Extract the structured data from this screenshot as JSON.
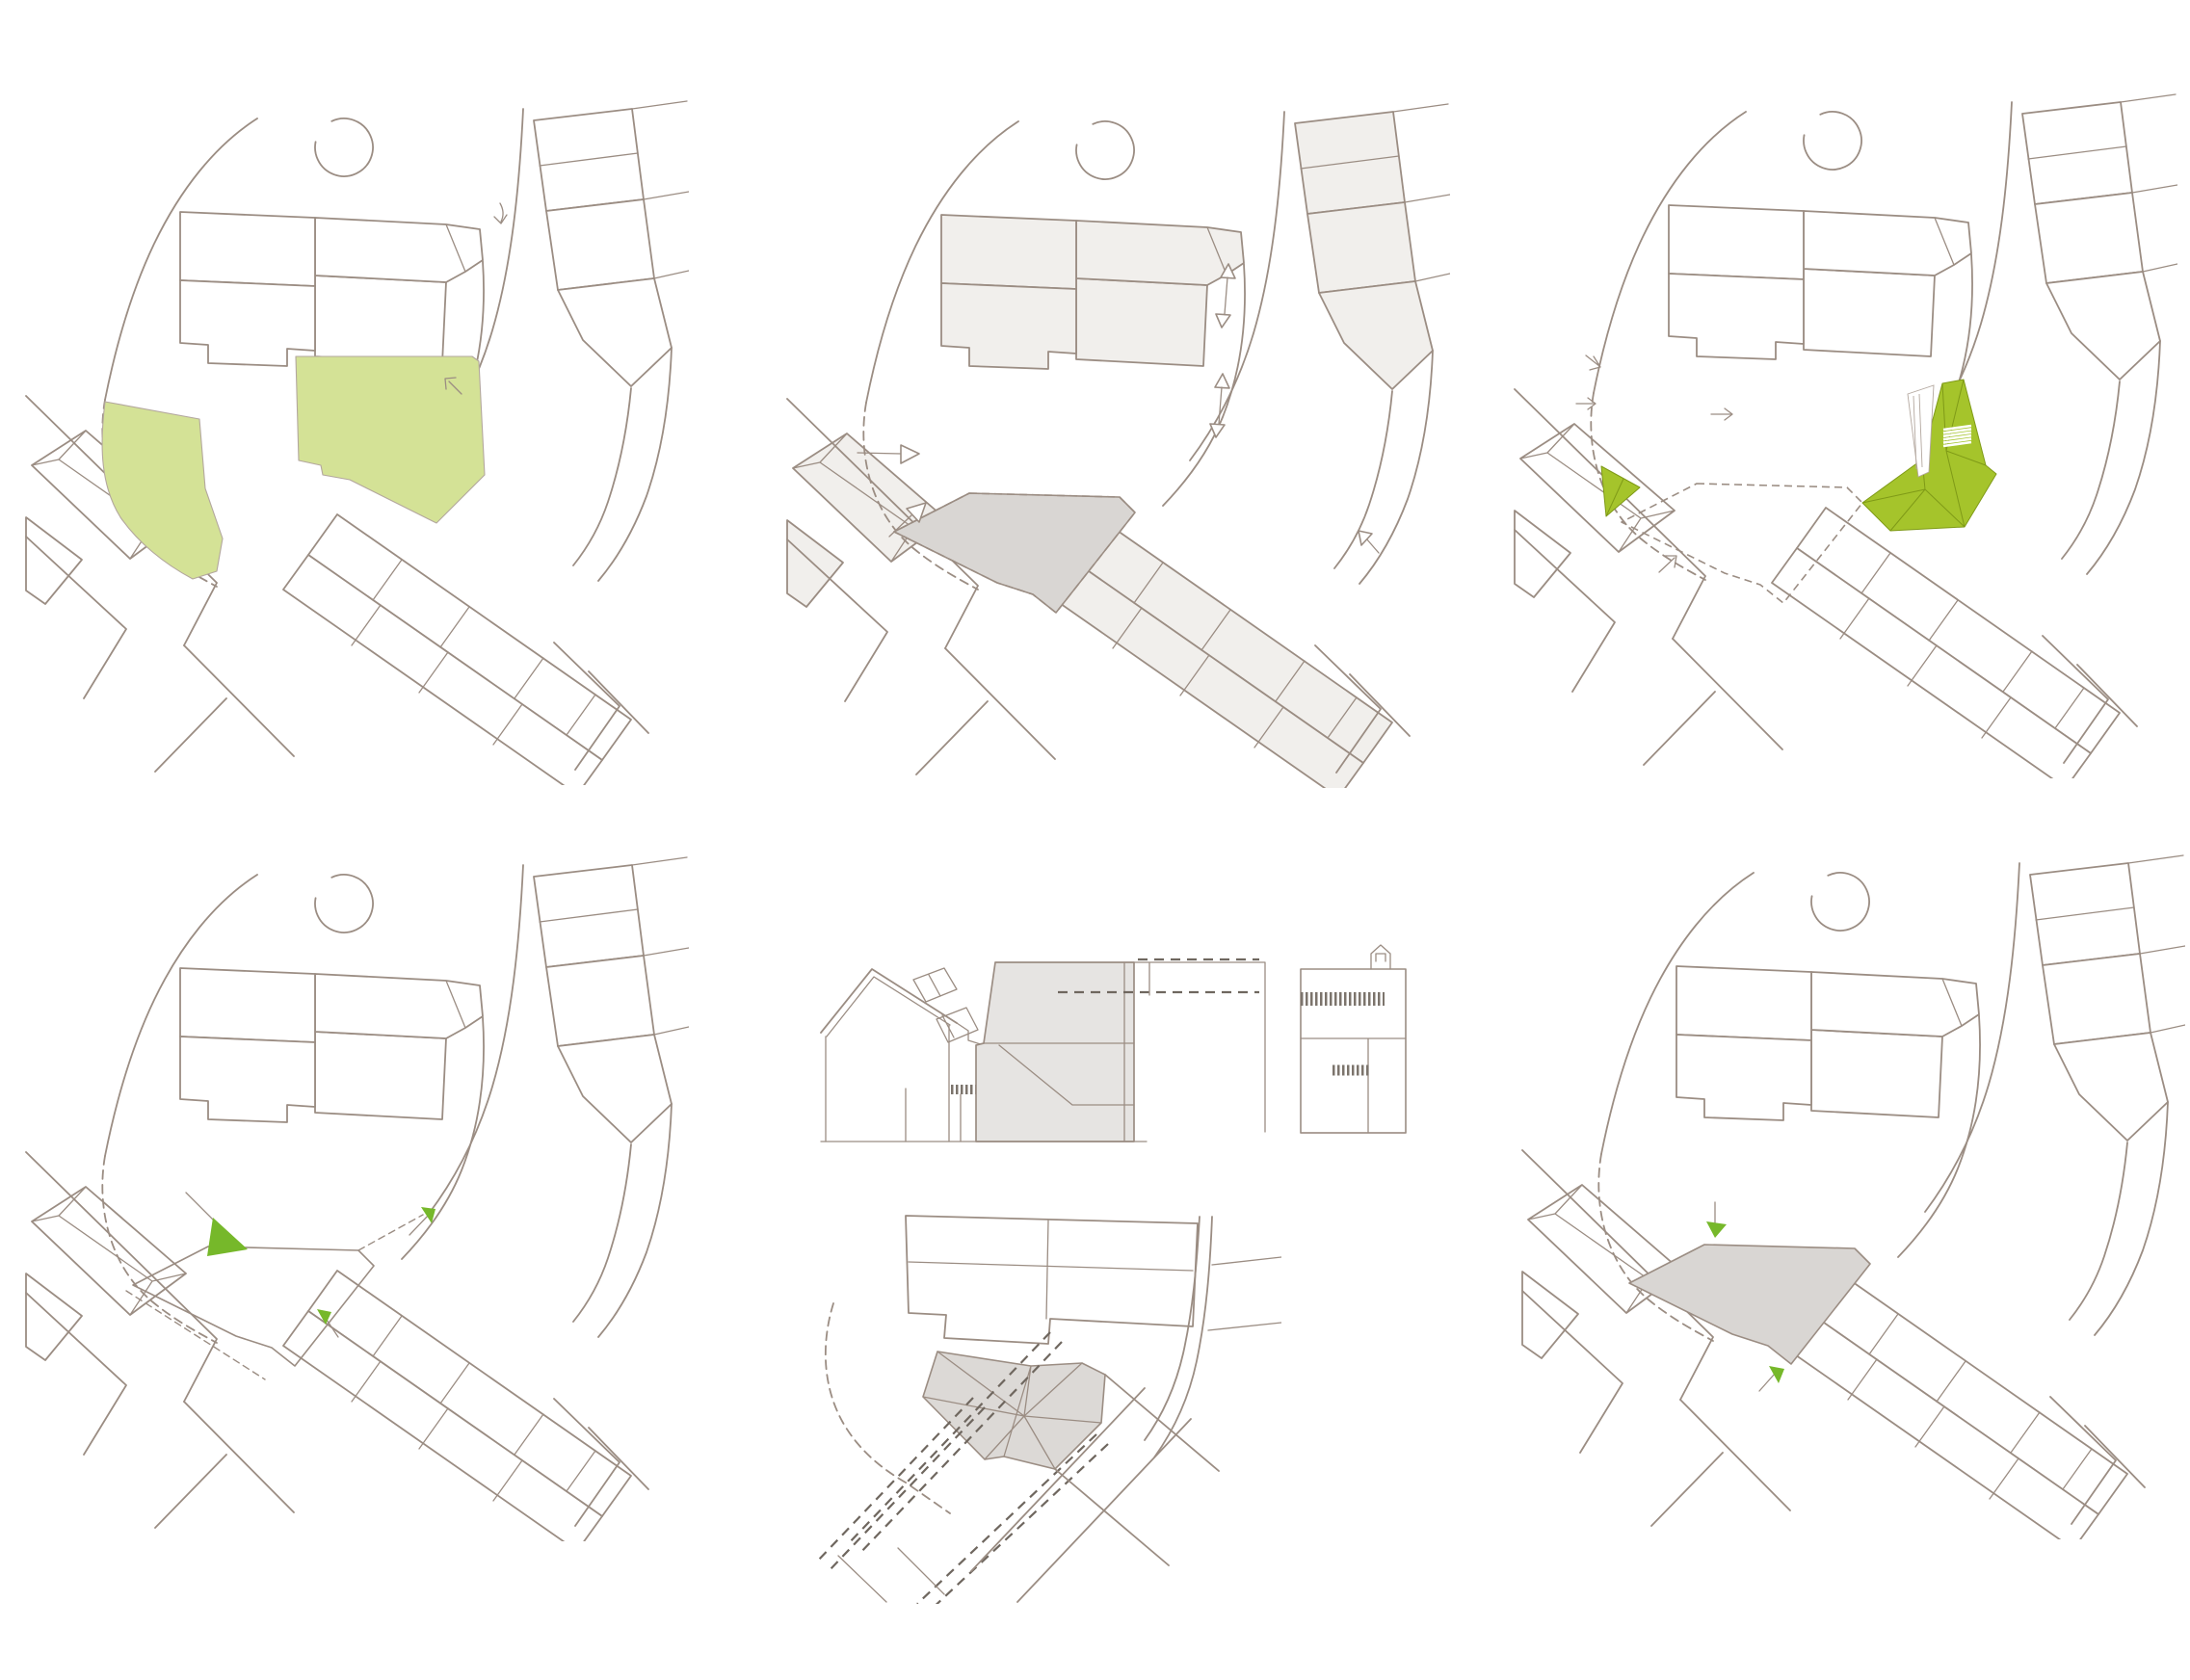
{
  "document": {
    "kind": "architectural-site-concept-diagram-sheet",
    "grid": "2 rows x 3 columns",
    "visible_text": ""
  },
  "palette": {
    "page-bg": "#ffffff",
    "line": "#9b8d83",
    "line-soft": "#b3a79e",
    "block-white": "#ffffff",
    "block-gray": "#f1efec",
    "site-gray": "#d9d6d3",
    "roof-gray": "#dcd9d6",
    "elev-gray": "#e6e4e2",
    "green-light": "#d4e296",
    "green-olive": "#a5c42b",
    "green-olive-dark": "#7f9a17",
    "green-arrow": "#76b82a",
    "dash-dark": "#6f675f",
    "hatch-dark": "#7c746c"
  },
  "panels": [
    {
      "id": "open-spaces",
      "position": "top-left",
      "features": [
        "street-network-map",
        "tree-circle",
        "open-space-highlight-left",
        "open-space-highlight-right",
        "dashed-site-boundary",
        "small-direction-arrow-icon",
        "corner-arrow-icon"
      ]
    },
    {
      "id": "figure-ground-footprint",
      "position": "top-center",
      "features": [
        "street-network-map-gray-blocks",
        "site-footprint-gray",
        "dashed-site-boundary",
        "entry-arrow-icon-left-1",
        "entry-arrow-icon-left-2",
        "two-way-street-arrow-icon-upper",
        "two-way-street-arrow-icon-lower",
        "corner-arrow-icon"
      ]
    },
    {
      "id": "proposed-roofscape",
      "position": "top-right",
      "features": [
        "street-network-map",
        "proposed-building-olive-faceted-roof",
        "pocket-green-triangle",
        "pedestrian-ramp-through-building",
        "crosswalk-hatch",
        "dashed-site-boundary",
        "flow-arrow-icons"
      ]
    },
    {
      "id": "site-access",
      "position": "bottom-left",
      "features": [
        "street-network-map",
        "site-outline",
        "dashed-site-boundary",
        "green-entry-arrow-large-nw",
        "green-entry-arrow-small-ne",
        "green-entry-arrow-small-south"
      ]
    },
    {
      "id": "section-and-roof-plan",
      "position": "bottom-center",
      "features": [
        "street-elevation-drawing",
        "gabled-house-with-dormers",
        "proposed-infill-gray-mass",
        "dashed-datum-lines",
        "railing-hatch-bands",
        "stepped-flat-roof-building",
        "roof-plan-gray-faceted",
        "alignment-dashed-lines",
        "dashed-site-boundary"
      ]
    },
    {
      "id": "footprint-access",
      "position": "bottom-right",
      "features": [
        "street-network-map",
        "site-footprint-gray",
        "dashed-site-boundary",
        "green-entry-arrow-north",
        "green-entry-arrow-south"
      ]
    }
  ]
}
